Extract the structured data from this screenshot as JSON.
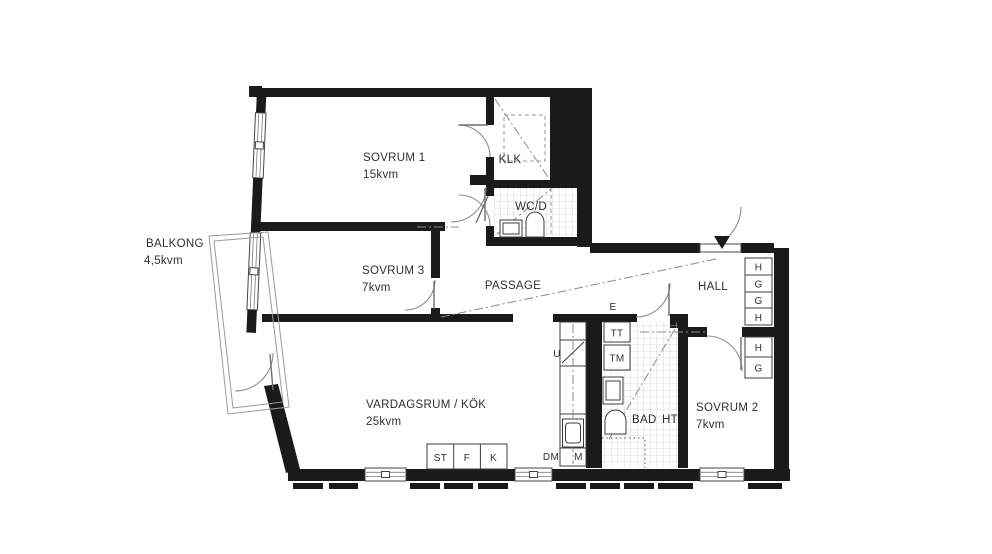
{
  "plan": {
    "rooms": {
      "sovrum1": {
        "name": "SOVRUM 1",
        "area": "15kvm"
      },
      "sovrum3": {
        "name": "SOVRUM 3",
        "area": "7kvm"
      },
      "sovrum2": {
        "name": "SOVRUM 2",
        "area": "7kvm"
      },
      "vardagsrum": {
        "name": "VARDAGSRUM / KÖK",
        "area": "25kvm"
      },
      "balkong": {
        "name": "BALKONG",
        "area": "4,5kvm"
      },
      "passage": {
        "name": "PASSAGE"
      },
      "hall": {
        "name": "HALL"
      },
      "klk": {
        "name": "KLK"
      },
      "wcd": {
        "name": "WC/D"
      },
      "bad": {
        "name": "BAD"
      }
    },
    "fixtures": {
      "ht": "HT",
      "e": "E",
      "u": "U",
      "tt": "TT",
      "tm": "TM",
      "dm": "DM",
      "m": "M",
      "st": "ST",
      "f": "F",
      "k": "K"
    },
    "wardrobes": {
      "upper": [
        "H",
        "G",
        "G",
        "H"
      ],
      "lower": [
        "H",
        "G"
      ]
    },
    "colors": {
      "wall": "#1a1a1a",
      "line_gray": "#8c8c8c",
      "tile_gray": "#d0d0d0",
      "text": "#2f2f2f",
      "background": "#ffffff"
    }
  }
}
